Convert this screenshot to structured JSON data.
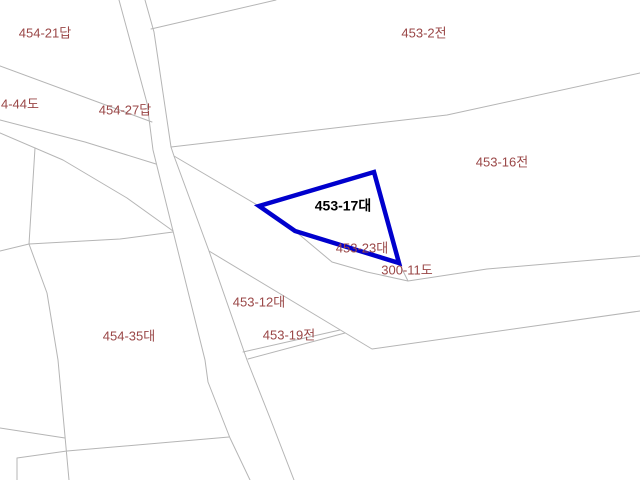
{
  "map": {
    "width": 640,
    "height": 480,
    "background_color": "#ffffff",
    "boundary_line_color": "#b5b5b5",
    "parcel_label_color": "#9a4747",
    "selected_parcel_label_color": "#000000",
    "selected_parcel_outline_color": "#0000cd",
    "selected_parcel": {
      "name": "453-17대",
      "points": [
        [
          259,
          206
        ],
        [
          374,
          172
        ],
        [
          399,
          263
        ],
        [
          295,
          231
        ]
      ]
    },
    "boundary_lines": [
      {
        "name": "road-left-edge",
        "points": [
          [
            119,
            0
          ],
          [
            147,
            103
          ],
          [
            153,
            150
          ],
          [
            173,
            231
          ],
          [
            205,
            360
          ],
          [
            208,
            382
          ],
          [
            230,
            438
          ],
          [
            250,
            480
          ]
        ]
      },
      {
        "name": "road-right-edge",
        "points": [
          [
            145,
            0
          ],
          [
            154,
            32
          ],
          [
            171,
            147
          ],
          [
            174,
            156
          ],
          [
            209,
            251
          ],
          [
            247,
            360
          ],
          [
            270,
            418
          ],
          [
            294,
            480
          ]
        ]
      },
      {
        "name": "parcel-453-2-west-boundary",
        "points": [
          [
            151,
            29
          ],
          [
            276,
            0
          ]
        ]
      },
      {
        "name": "boundary-453-2-453-16",
        "points": [
          [
            171,
            147
          ],
          [
            360,
            125
          ],
          [
            447,
            115
          ],
          [
            640,
            73
          ]
        ]
      },
      {
        "name": "boundary-453-16-west",
        "points": [
          [
            174,
            156
          ],
          [
            259,
            206
          ]
        ]
      },
      {
        "name": "road-300-11-top-edge",
        "points": [
          [
            295,
            231
          ],
          [
            332,
            262
          ],
          [
            367,
            272
          ],
          [
            408,
            281
          ],
          [
            487,
            269
          ],
          [
            640,
            256
          ]
        ]
      },
      {
        "name": "boundary-453-23-east",
        "points": [
          [
            399,
            263
          ],
          [
            408,
            281
          ]
        ]
      },
      {
        "name": "road-300-11-bottom-edge",
        "points": [
          [
            209,
            251
          ],
          [
            372,
            349
          ],
          [
            640,
            311
          ]
        ]
      },
      {
        "name": "strip-453-19-upper-edge",
        "points": [
          [
            243,
            352
          ],
          [
            340,
            330
          ]
        ]
      },
      {
        "name": "strip-453-19-lower-edge",
        "points": [
          [
            248,
            359
          ],
          [
            345,
            333
          ]
        ]
      },
      {
        "name": "boundary-454-21-south",
        "points": [
          [
            0,
            66
          ],
          [
            152,
            122
          ]
        ]
      },
      {
        "name": "boundary-4-44-south",
        "points": [
          [
            0,
            120
          ],
          [
            85,
            142
          ],
          [
            156,
            164
          ]
        ]
      },
      {
        "name": "boundary-454-7-north",
        "points": [
          [
            0,
            133
          ],
          [
            63,
            160
          ],
          [
            127,
            198
          ],
          [
            173,
            231
          ]
        ]
      },
      {
        "name": "boundary-454-7-south",
        "points": [
          [
            0,
            251
          ],
          [
            29,
            244
          ],
          [
            120,
            239
          ],
          [
            173,
            232
          ]
        ]
      },
      {
        "name": "boundary-west-small-parcel",
        "points": [
          [
            35,
            148
          ],
          [
            29,
            244
          ]
        ]
      },
      {
        "name": "boundary-454-35-west",
        "points": [
          [
            29,
            244
          ],
          [
            47,
            293
          ],
          [
            58,
            360
          ],
          [
            69,
            480
          ]
        ]
      },
      {
        "name": "boundary-454-35-south",
        "points": [
          [
            17,
            480
          ],
          [
            17,
            458
          ],
          [
            67,
            451
          ],
          [
            229,
            437
          ]
        ]
      },
      {
        "name": "boundary-bottom-left",
        "points": [
          [
            0,
            428
          ],
          [
            65,
            438
          ]
        ]
      }
    ],
    "parcel_labels": [
      {
        "name": "label-454-21",
        "text": "454-21답",
        "x": 45,
        "y": 33,
        "selected": false
      },
      {
        "name": "label-453-2",
        "text": "453-2전",
        "x": 424,
        "y": 33,
        "selected": false
      },
      {
        "name": "label-4-44",
        "text": "4-44도",
        "x": 20,
        "y": 104,
        "selected": false
      },
      {
        "name": "label-454-27",
        "text": "454-27답",
        "x": 125,
        "y": 110,
        "selected": false
      },
      {
        "name": "label-453-16",
        "text": "453-16전",
        "x": 502,
        "y": 162,
        "selected": false
      },
      {
        "name": "label-453-17",
        "text": "453-17대",
        "x": 343,
        "y": 206,
        "selected": true
      },
      {
        "name": "label-453-23",
        "text": "453-23대",
        "x": 362,
        "y": 248,
        "selected": false
      },
      {
        "name": "label-300-11",
        "text": "300-11도",
        "x": 407,
        "y": 270,
        "selected": false
      },
      {
        "name": "label-453-12",
        "text": "453-12대",
        "x": 259,
        "y": 302,
        "selected": false
      },
      {
        "name": "label-453-19",
        "text": "453-19전",
        "x": 289,
        "y": 335,
        "selected": false
      },
      {
        "name": "label-454-35",
        "text": "454-35대",
        "x": 129,
        "y": 336,
        "selected": false
      }
    ]
  }
}
